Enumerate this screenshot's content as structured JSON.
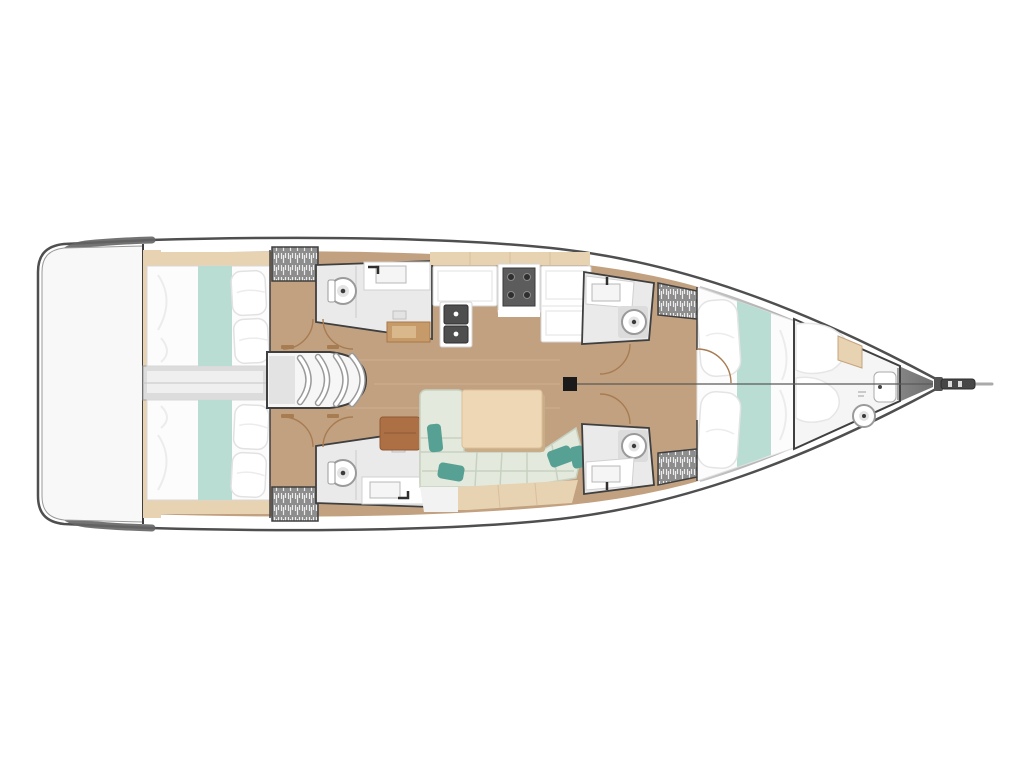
{
  "diagram": {
    "type": "yacht-deck-floorplan",
    "orientation": "bow-right",
    "background": "plain white, no text or labels visible",
    "components": [
      {
        "name": "swim-platform",
        "label": "transom swim platform (stern)"
      },
      {
        "name": "aft-cabin-port",
        "label": "aft double cabin with berth, teal runner and pillows (top)"
      },
      {
        "name": "aft-cabin-starboard",
        "label": "aft double cabin with berth, teal runner and pillows (bottom)"
      },
      {
        "name": "engine-compartment",
        "label": "engine box between aft cabins"
      },
      {
        "name": "companionway-steps",
        "label": "curved companionway steps to cockpit"
      },
      {
        "name": "head-aft-port",
        "label": "aft port head: toilet, sink, shower"
      },
      {
        "name": "head-aft-starboard",
        "label": "aft starboard head: toilet, sink, shower"
      },
      {
        "name": "head-mid-port",
        "label": "mid port head: sink and toilet"
      },
      {
        "name": "head-mid-starboard",
        "label": "mid starboard head: sink and toilet"
      },
      {
        "name": "wardrobe",
        "label": "hanging lockers (hatched), four positions"
      },
      {
        "name": "galley",
        "label": "galley: double sink, gas stove, counters"
      },
      {
        "name": "chart-table",
        "label": "chart table"
      },
      {
        "name": "nav-seat",
        "label": "brown nav seat / side table"
      },
      {
        "name": "salon",
        "label": "U-shaped settee with green cushions, teal accent pillows, wood table"
      },
      {
        "name": "forward-cabin",
        "label": "forward V-berth cabin with pillows and teal runner"
      },
      {
        "name": "forepeak-head",
        "label": "forepeak compartment with toilet and basin"
      },
      {
        "name": "mast",
        "label": "mast foot on centerline"
      },
      {
        "name": "forestay",
        "label": "centerline rigging line from mast to bow"
      },
      {
        "name": "bowsprit",
        "label": "bow fitting / anchor roller"
      }
    ]
  },
  "colors": {
    "background": "#ffffff",
    "hull_fill": "#ffffff",
    "hull_outline": "#4f4f4f",
    "rim_dark": "#646464",
    "bow_gray_light": "#c6c6c6",
    "bow_gray_dark": "#6f6f6f",
    "floor_tan": "#c2a181",
    "floor_seam": "#d9bd9b",
    "shelf_tan": "#e7d2b2",
    "bed_white": "#fcfcfc",
    "head_floor": "#eaeaea",
    "runner_teal": "#b9dcd3",
    "pillow_teal": "#57a094",
    "sofa_green": "#e4e9dd",
    "sofa_seam": "#c7d1c1",
    "table_wood": "#eed7b4",
    "wood_mid": "#c79a6a",
    "seat_brown": "#ad7044",
    "engine_gray": "#dcdcdc",
    "steps_gray": "#9a9a9a",
    "room_border": "#3f3f3f",
    "fixture_gray": "#9a9a9a",
    "dark_fixture": "#4e4e4e",
    "stove_dark": "#5c5c5c",
    "wardrobe_gray": "#8d8d8d",
    "wardrobe_hatch": "#ececec",
    "door_arc": "#a87c52",
    "mast_black": "#1a1a1a",
    "sprit_dark": "#474747"
  }
}
